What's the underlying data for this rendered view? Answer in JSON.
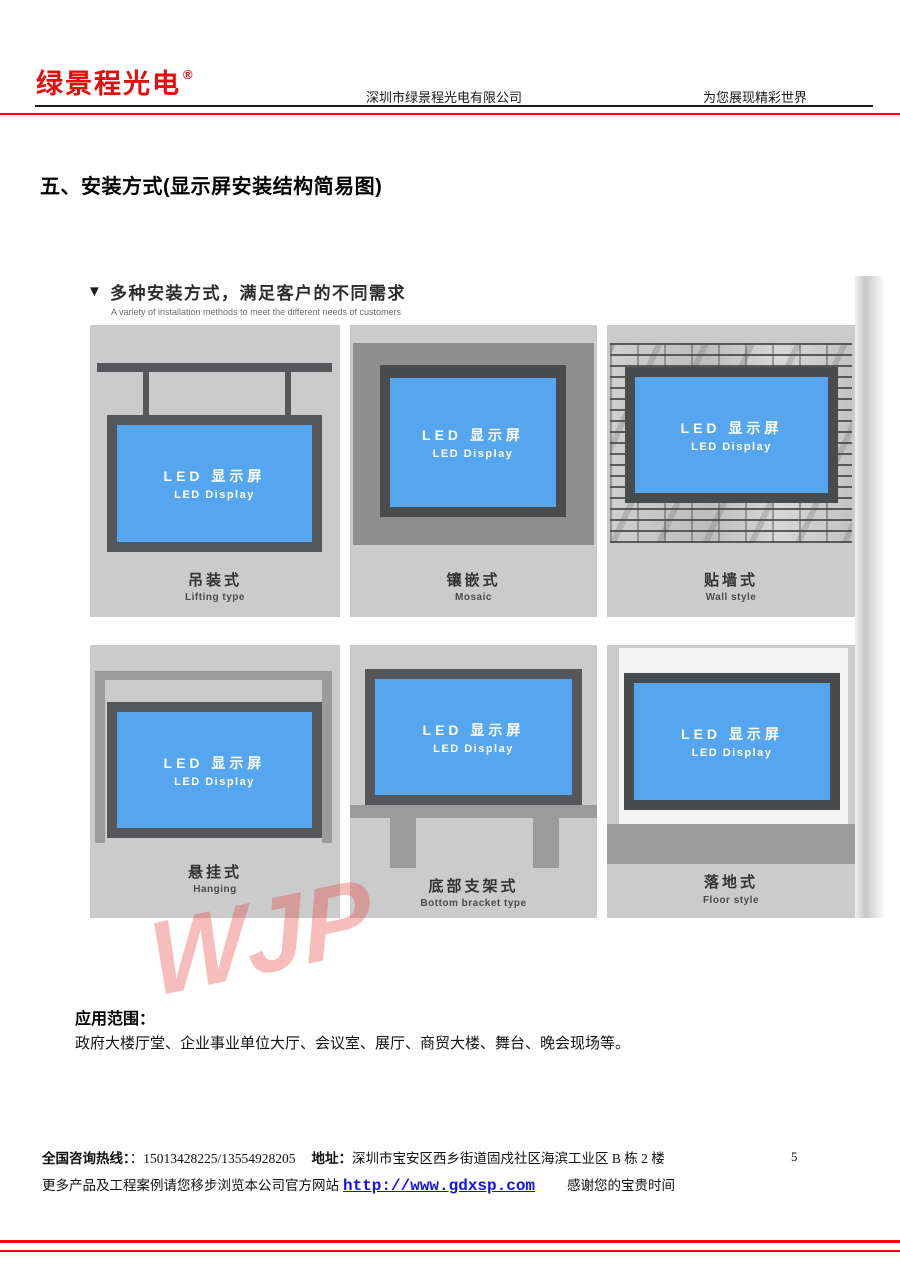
{
  "header": {
    "logo": "绿景程光电",
    "registered": "®",
    "company": "深圳市绿景程光电有限公司",
    "slogan": "为您展现精彩世界"
  },
  "section_title": "五、安装方式(显示屏安装结构简易图)",
  "panel": {
    "marker": "▼",
    "title": "多种安装方式，满足客户的不同需求",
    "subtitle": "A variety of installation methods to meet the different needs of customers",
    "screen_label_cn": "LED 显示屏",
    "screen_label_en": "LED Display",
    "cells": [
      {
        "cn": "吊装式",
        "en": "Lifting type"
      },
      {
        "cn": "镶嵌式",
        "en": "Mosaic"
      },
      {
        "cn": "贴墙式",
        "en": "Wall style"
      },
      {
        "cn": "悬挂式",
        "en": "Hanging"
      },
      {
        "cn": "底部支架式",
        "en": "Bottom bracket type"
      },
      {
        "cn": "落地式",
        "en": "Floor style"
      }
    ]
  },
  "watermark": {
    "text": "WJP"
  },
  "application": {
    "label": "应用范围：",
    "text": "政府大楼厅堂、企业事业单位大厅、会议室、展厅、商贸大楼、舞台、晚会现场等。"
  },
  "footer": {
    "hotline_label": "全国咨询热线：",
    "hotline_value": "：15013428225/13554928205",
    "address_label": "地址：",
    "address_value": "深圳市宝安区西乡街道固戍社区海滨工业区 B 栋 2 楼",
    "page_number": "5",
    "more_text": "更多产品及工程案例请您移步浏览本公司官方网站",
    "url": "http://www.gdxsp.com",
    "thanks": "感谢您的宝贵时间"
  },
  "colors": {
    "brand_red": "#e80b0b",
    "rule_red": "#fe0404",
    "screen_blue": "#55a6ef",
    "frame_gray": "#56575a",
    "cell_bg": "#cbcbcb",
    "support_gray": "#9b9b9b",
    "link_blue": "#1111ee",
    "watermark_pink": "rgba(228,62,56,0.34)"
  }
}
